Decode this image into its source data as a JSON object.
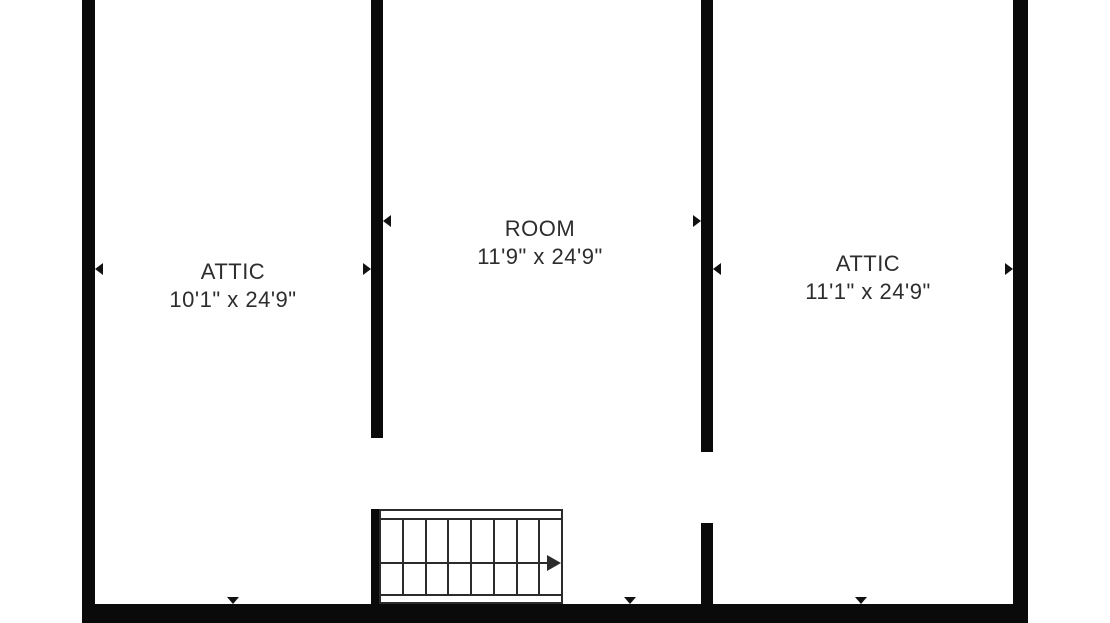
{
  "colors": {
    "wall": "#0a0a0a",
    "text": "#2d2d2d",
    "stair_line": "#2b2b2b",
    "marker": "#111111",
    "background": "#ffffff"
  },
  "rooms": [
    {
      "name": "ATTIC",
      "dimensions": "10'1\" x 24'9\""
    },
    {
      "name": "ROOM",
      "dimensions": "11'9\" x 24'9\""
    },
    {
      "name": "ATTIC",
      "dimensions": "11'1\" x 24'9\""
    }
  ],
  "stairs": {
    "treads": 8,
    "direction": "right"
  }
}
